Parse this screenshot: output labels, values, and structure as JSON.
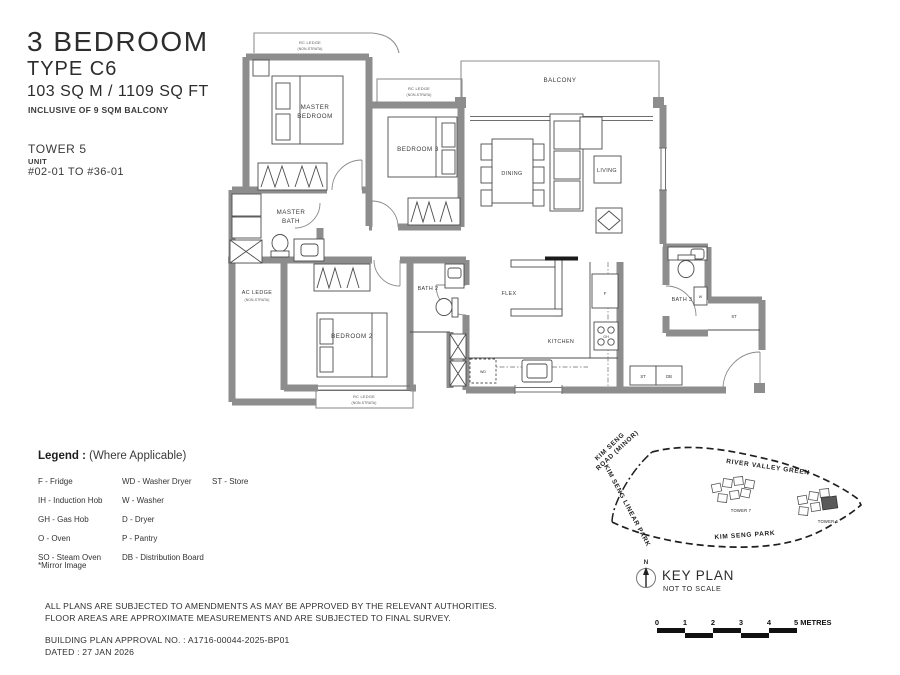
{
  "header": {
    "title": "3 BEDROOM",
    "subtitle": "TYPE C6",
    "area": "103 SQ M / 1109 SQ FT",
    "balcony_note": "INCLUSIVE OF 9 SQM BALCONY",
    "tower": "TOWER 5",
    "unit_label": "UNIT",
    "unit_range": "#02-01 TO #36-01"
  },
  "floorplan": {
    "rooms": {
      "master_bedroom_l1": "MASTER",
      "master_bedroom_l2": "BEDROOM",
      "bedroom_3": "BEDROOM 3",
      "balcony": "BALCONY",
      "dining": "DINING",
      "living": "LIVING",
      "master_bath_l1": "MASTER",
      "master_bath_l2": "BATH",
      "ac_ledge_l1": "AC LEDGE",
      "ac_ledge_l2": "(NON-STRATA)",
      "bedroom_2": "BEDROOM 2",
      "bath_2": "BATH 2",
      "flex": "FLEX",
      "kitchen": "KITCHEN",
      "bath_3": "BATH 3",
      "rc_ledge_l1": "RC LEDGE",
      "rc_ledge_l2": "(NON-STRATA)"
    },
    "tags": {
      "fridge": "F",
      "gas_hob": "GH",
      "washer_dryer": "WD",
      "washer": "W",
      "store": "ST",
      "distribution_board": "DB"
    }
  },
  "legend": {
    "title": "Legend :",
    "subtitle": "(Where Applicable)",
    "columns": [
      [
        "F - Fridge",
        "IH - Induction Hob",
        "GH - Gas Hob",
        "O - Oven",
        "SO - Steam Oven"
      ],
      [
        "WD - Washer Dryer",
        "W - Washer",
        "D - Dryer",
        "P - Pantry",
        "DB - Distribution Board"
      ],
      [
        "ST - Store"
      ]
    ],
    "mirror_note": "*Mirror Image"
  },
  "keyplan": {
    "title": "KEY PLAN",
    "subtitle": "NOT TO SCALE",
    "compass_label": "N",
    "labels": {
      "road_l1": "KIM SENG",
      "road_l2": "ROAD (MINOR)",
      "linear_park": "KIM SENG LINEAR PARK",
      "river_valley": "RIVER VALLEY GREEN",
      "park": "KIM SENG PARK",
      "tower7": "TOWER 7",
      "tower5": "TOWER 5"
    }
  },
  "scalebar": {
    "ticks": [
      "0",
      "1",
      "2",
      "3",
      "4"
    ],
    "unit_label": "5 METRES"
  },
  "footer": {
    "line1": "ALL PLANS ARE SUBJECTED TO AMENDMENTS AS MAY BE APPROVED BY THE RELEVANT AUTHORITIES.",
    "line2": "FLOOR AREAS ARE APPROXIMATE MEASUREMENTS AND ARE SUBJECTED TO FINAL SURVEY.",
    "approval": "BUILDING PLAN APPROVAL NO. : A1716-00044-2025-BP01",
    "dated": "DATED : 27 JAN 2026"
  }
}
